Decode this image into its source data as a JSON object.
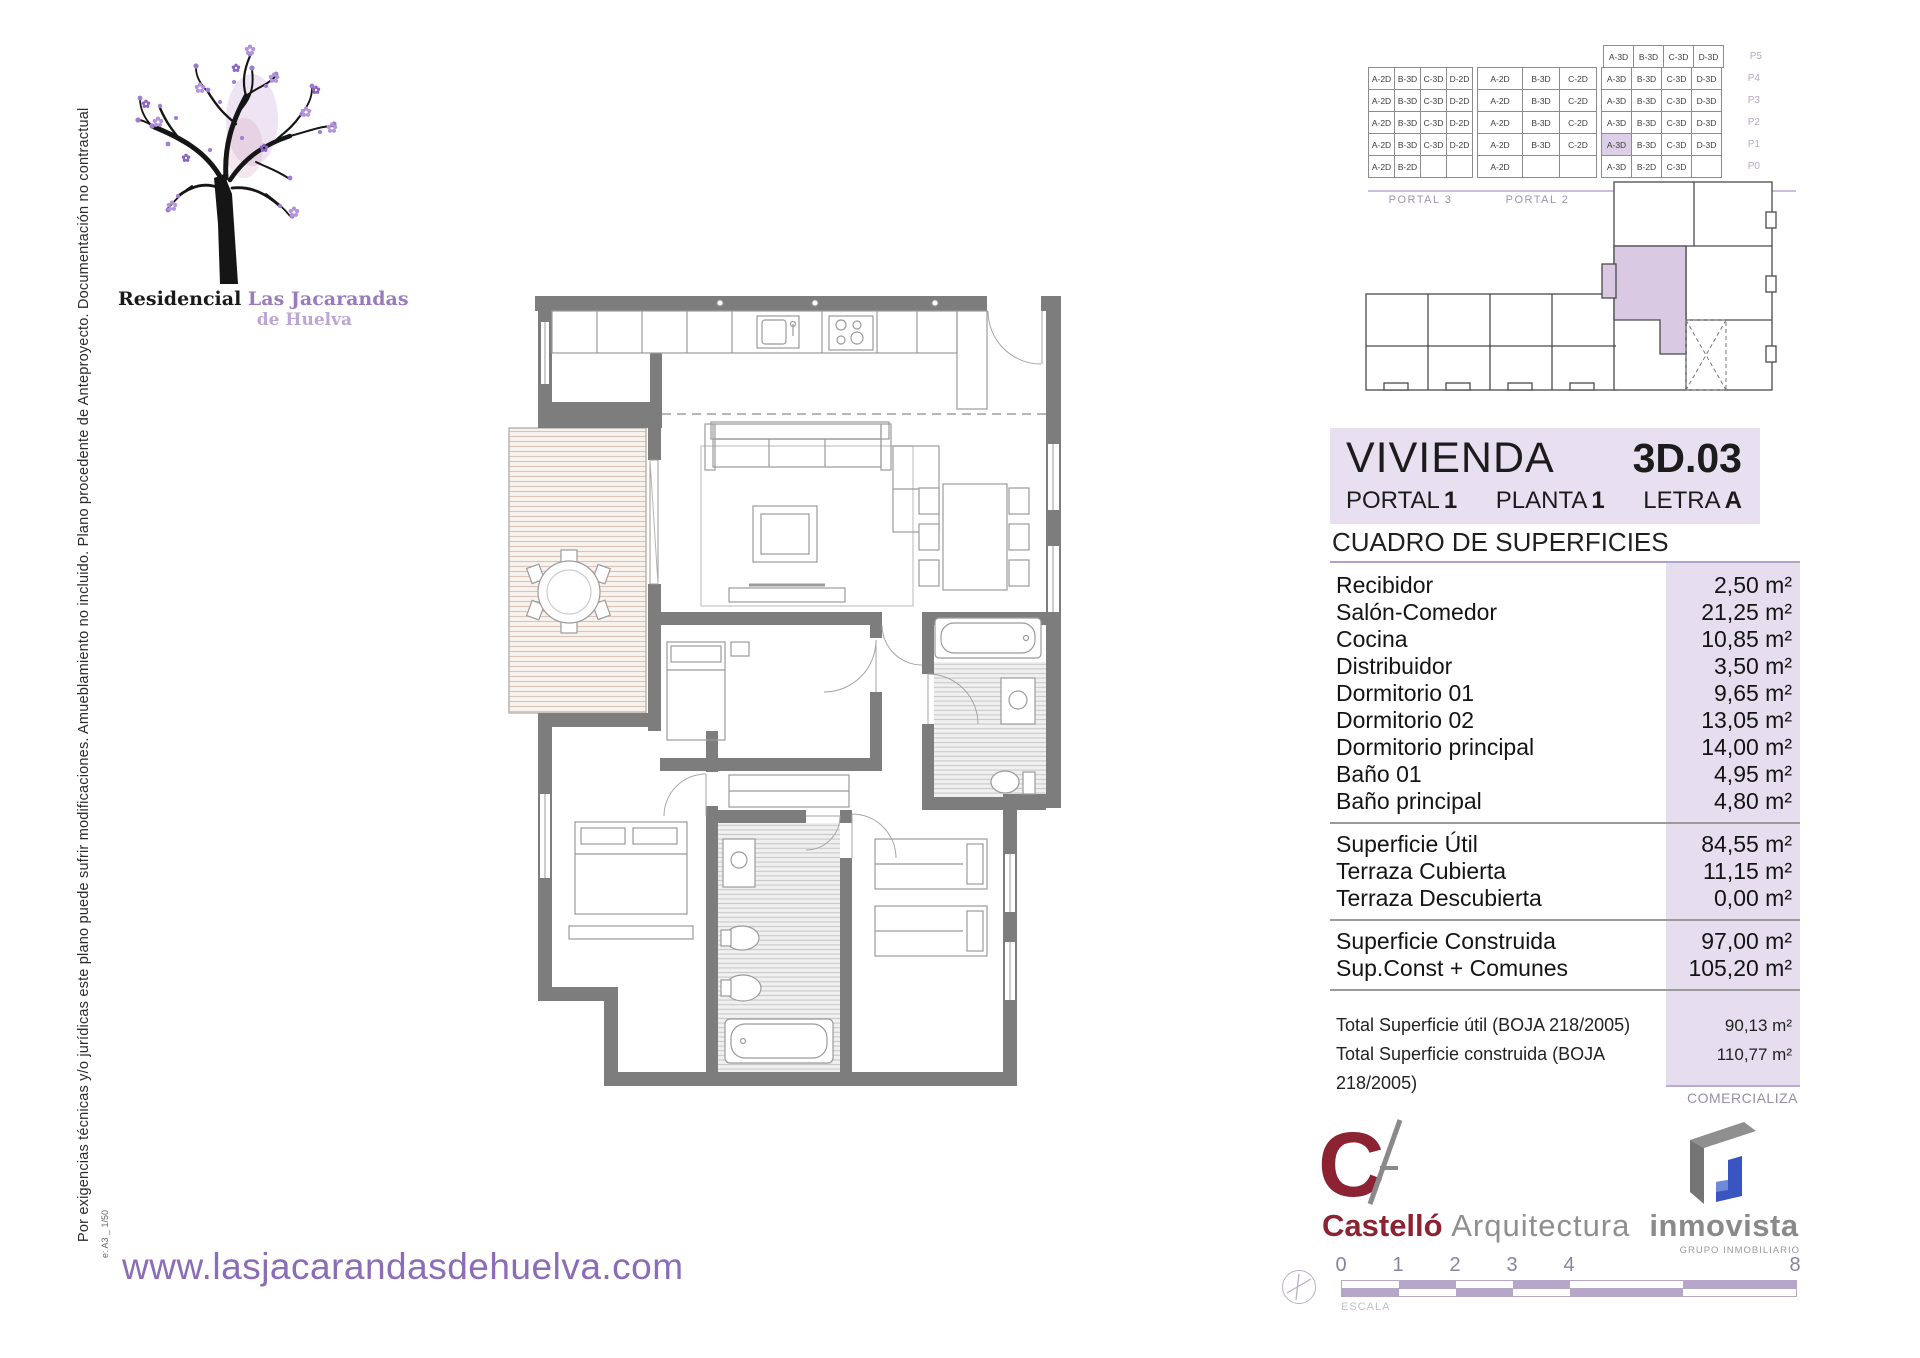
{
  "branding": {
    "residencial": "Residencial",
    "name": "Las Jacarandas",
    "sub": "de Huelva",
    "website": "www.lasjacarandasdehuelva.com",
    "comercializa": "COMERCIALIZA",
    "castello_name": "Castelló",
    "castello_suffix": "Arquitectura",
    "inmovista_name": "inmovista",
    "inmovista_tagline": "GRUPO INMOBILIARIO"
  },
  "disclaimer": "Por exigencias técnicas y/o jurídicas este plano puede sufrir modificaciones. Amueblamiento no incluido. Plano procedente de Anteproyecto. Documentación no contractual",
  "sheet_note": "e: A3 _ 1/50",
  "unit_header": {
    "title": "VIVIENDA",
    "code": "3D.03",
    "portal_label": "PORTAL",
    "portal": "1",
    "planta_label": "PLANTA",
    "planta": "1",
    "letra_label": "LETRA",
    "letra": "A"
  },
  "surfaces": {
    "title": "CUADRO DE SUPERFICIES",
    "sections": [
      {
        "rows": [
          [
            "Recibidor",
            "2,50 m²"
          ],
          [
            "Salón-Comedor",
            "21,25 m²"
          ],
          [
            "Cocina",
            "10,85 m²"
          ],
          [
            "Distribuidor",
            "3,50 m²"
          ],
          [
            "Dormitorio 01",
            "9,65 m²"
          ],
          [
            "Dormitorio 02",
            "13,05 m²"
          ],
          [
            "Dormitorio principal",
            "14,00 m²"
          ],
          [
            "Baño 01",
            "4,95 m²"
          ],
          [
            "Baño principal",
            "4,80 m²"
          ]
        ]
      },
      {
        "rows": [
          [
            "Superficie Útil",
            "84,55 m²"
          ],
          [
            "Terraza Cubierta",
            "11,15 m²"
          ],
          [
            "Terraza Descubierta",
            "0,00 m²"
          ]
        ]
      },
      {
        "rows": [
          [
            "Superficie Construida",
            "97,00 m²"
          ],
          [
            "Sup.Const + Comunes",
            "105,20 m²"
          ]
        ]
      },
      {
        "small": true,
        "rows": [
          [
            "Total Superficie útil (BOJA 218/2005)",
            "90,13 m²"
          ],
          [
            "Total Superficie construida (BOJA 218/2005)",
            "110,77 m²"
          ]
        ]
      }
    ]
  },
  "stack": {
    "floors": [
      {
        "label": "P5",
        "groups": [
          null,
          null,
          [
            "A-3D",
            "B-3D",
            "C-3D",
            "D-3D"
          ]
        ]
      },
      {
        "label": "P4",
        "groups": [
          [
            "A-2D",
            "B-3D",
            "C-3D",
            "D-2D"
          ],
          [
            "A-2D",
            "B-3D",
            "C-2D"
          ],
          [
            "A-3D",
            "B-3D",
            "C-3D",
            "D-3D"
          ]
        ]
      },
      {
        "label": "P3",
        "groups": [
          [
            "A-2D",
            "B-3D",
            "C-3D",
            "D-2D"
          ],
          [
            "A-2D",
            "B-3D",
            "C-2D"
          ],
          [
            "A-3D",
            "B-3D",
            "C-3D",
            "D-3D"
          ]
        ]
      },
      {
        "label": "P2",
        "groups": [
          [
            "A-2D",
            "B-3D",
            "C-3D",
            "D-2D"
          ],
          [
            "A-2D",
            "B-3D",
            "C-2D"
          ],
          [
            "A-3D",
            "B-3D",
            "C-3D",
            "D-3D"
          ]
        ]
      },
      {
        "label": "P1",
        "groups": [
          [
            "A-2D",
            "B-3D",
            "C-3D",
            "D-2D"
          ],
          [
            "A-2D",
            "B-3D",
            "C-2D"
          ],
          [
            "A-3D",
            "B-3D",
            "C-3D",
            "D-3D"
          ]
        ]
      },
      {
        "label": "P0",
        "groups": [
          [
            "A-2D",
            "B-2D",
            "",
            ""
          ],
          [
            "A-2D",
            "",
            ""
          ],
          [
            "A-3D",
            "B-2D",
            "C-3D",
            ""
          ]
        ]
      }
    ],
    "portals": [
      "PORTAL 3",
      "PORTAL 2",
      "PORTAL 1"
    ],
    "highlight": {
      "floor": "P1",
      "group": 2,
      "cell": 0
    }
  },
  "scale": {
    "label": "ESCALA",
    "ticks": [
      {
        "t": "0",
        "x": 0
      },
      {
        "t": "1",
        "x": 57
      },
      {
        "t": "2",
        "x": 114
      },
      {
        "t": "3",
        "x": 171
      },
      {
        "t": "4",
        "x": 228
      },
      {
        "t": "8",
        "x": 454
      }
    ],
    "segments": [
      {
        "w": 57,
        "top": "#ffffff",
        "bot": "#b6a7c9"
      },
      {
        "w": 57,
        "top": "#b6a7c9",
        "bot": "#ffffff"
      },
      {
        "w": 57,
        "top": "#ffffff",
        "bot": "#b6a7c9"
      },
      {
        "w": 57,
        "top": "#b6a7c9",
        "bot": "#ffffff"
      },
      {
        "w": 113,
        "top": "#ffffff",
        "bot": "#b6a7c9"
      },
      {
        "w": 113,
        "top": "#b6a7c9",
        "bot": "#ffffff"
      }
    ]
  },
  "colors": {
    "accent_purple": "#8a6cb8",
    "header_bg": "#e8dff0",
    "strip_bg": "#e6ddef",
    "highlight_cell": "#dccfe7",
    "wall_gray": "#7d7d7d",
    "castello_red": "#8c2332",
    "inmovista_blue": "#3a55c0"
  }
}
